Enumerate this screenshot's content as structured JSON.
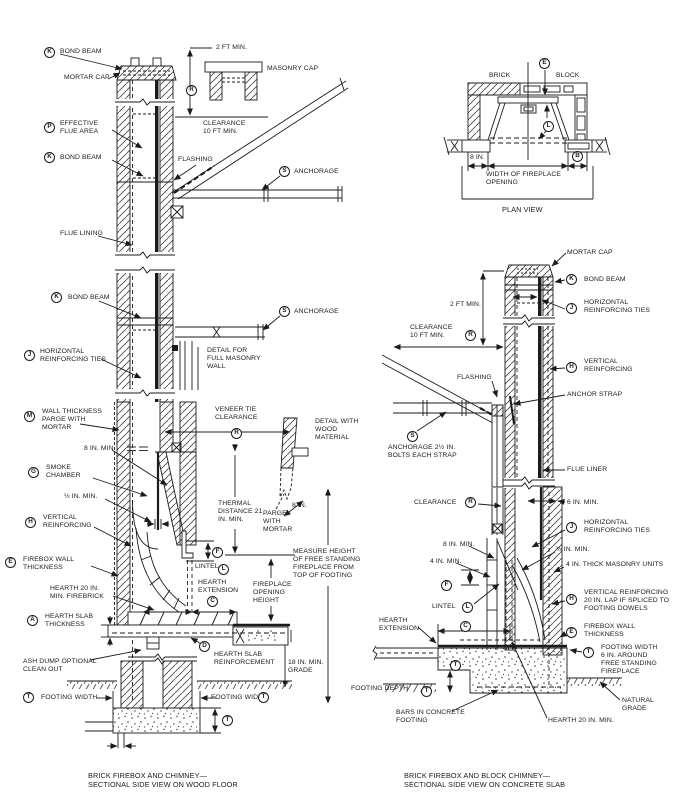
{
  "callouts": {
    "A": "A",
    "B": "B",
    "C": "C",
    "D": "D",
    "E": "E",
    "F": "F",
    "G": "G",
    "H": "H",
    "J": "J",
    "K": "K",
    "L": "L",
    "M": "M",
    "P": "P",
    "R": "R",
    "S": "S",
    "T": "T"
  },
  "left": {
    "bond_beam": "BOND BEAM",
    "mortar_cap": "MORTAR CAP",
    "two_ft_min": "2 FT MIN.",
    "masonry_cap": "MASONRY CAP",
    "effective_flue_area": "EFFECTIVE\nFLUE AREA",
    "clearance_10ft": "CLEARANCE\n10 FT MIN.",
    "flashing": "FLASHING",
    "anchorage": "ANCHORAGE",
    "flue_lining": "FLUE LINING",
    "horizontal_ties": "HORIZONTAL\nREINFORCING TIES",
    "detail_full_masonry": "DETAIL FOR\nFULL MASONRY\nWALL",
    "wall_thickness": "WALL THICKNESS\nPARGE WITH\nMORTAR",
    "veneer_tie": "VENEER TIE\nCLEARANCE",
    "eight_in_min": "8 IN. MIN.",
    "smoke_chamber": "SMOKE\nCHAMBER",
    "half_in_min": "½ IN. MIN.",
    "vertical_reinforcing": "VERTICAL\nREINFORCING",
    "thermal": "THERMAL\nDISTANCE 21\nIN. MIN.",
    "parge": "PARGE\nWITH\nMORTAR",
    "eight_in": "8 IN.",
    "detail_wood": "DETAIL WITH\nWOOD\nMATERIAL",
    "firebox_wall": "FIREBOX WALL\nTHICKNESS",
    "lintel": "LINTEL",
    "hearth_ext": "HEARTH\nEXTENSION",
    "opening_height": "FIREPLACE\nOPENING\nHEIGHT",
    "measure_height": "MEASURE HEIGHT\nOF FREE STANDING\nFIREPLACE FROM\nTOP OF FOOTING",
    "hearth_20": "HEARTH 20 IN.\nMIN. FIREBRICK",
    "slab_thickness": "HEARTH SLAB\nTHICKNESS",
    "slab_reinforcement": "HEARTH SLAB\nREINFORCEMENT",
    "grade_18": "18 IN. MIN.\nGRADE",
    "ash_dump": "ASH DUMP OPTIONAL\nCLEAN OUT",
    "footing_width": "FOOTING WIDTH",
    "caption": "BRICK FIREBOX AND CHIMNEY—\nSECTIONAL SIDE VIEW ON WOOD FLOOR"
  },
  "plan": {
    "brick": "BRICK",
    "block": "BLOCK",
    "eight_in": "8 IN.",
    "width_opening": "WIDTH OF FIREPLACE\nOPENING",
    "title": "PLAN VIEW"
  },
  "right": {
    "mortar_cap": "MORTAR CAP",
    "bond_beam": "BOND BEAM",
    "two_ft_min": "2 FT MIN.",
    "horizontal_ties": "HORIZONTAL\nREINFORCING TIES",
    "clearance_10ft": "CLEARANCE\n10 FT MIN.",
    "flashing": "FLASHING",
    "vertical_reinforcing": "VERTICAL\nREINFORCING",
    "anchor_strap": "ANCHOR STRAP",
    "anchorage_bolts": "ANCHORAGE 2½ IN.\nBOLTS EACH STRAP",
    "flue_liner": "FLUE LINER",
    "clearance": "CLEARANCE",
    "six_in_min": "6 IN. MIN.",
    "eight_in_min": "8 IN. MIN.",
    "half_in_min": "½ IN. MIN.",
    "four_in_min": "4 IN. MIN.",
    "four_in_units": "4 IN. THICK MASONRY UNITS",
    "vertical_lap": "VERTICAL REINFORCING\n20 IN. LAP IF SPLICED TO\nFOOTING DOWELS",
    "lintel": "LINTEL",
    "hearth_ext": "HEARTH\nEXTENSION",
    "firebox_wall": "FIREBOX WALL\nTHICKNESS",
    "footing_width_6": "FOOTING WIDTH\n6 IN. AROUND\nFREE STANDING\nFIREPLACE",
    "footing_depth": "FOOTING DEPTH",
    "natural_grade": "NATURAL\nGRADE",
    "bars": "BARS IN CONCRETE\nFOOTING",
    "hearth_20": "HEARTH 20 IN. MIN.",
    "caption": "BRICK FIREBOX AND BLOCK CHIMNEY—\nSECTIONAL SIDE VIEW ON CONCRETE SLAB"
  }
}
